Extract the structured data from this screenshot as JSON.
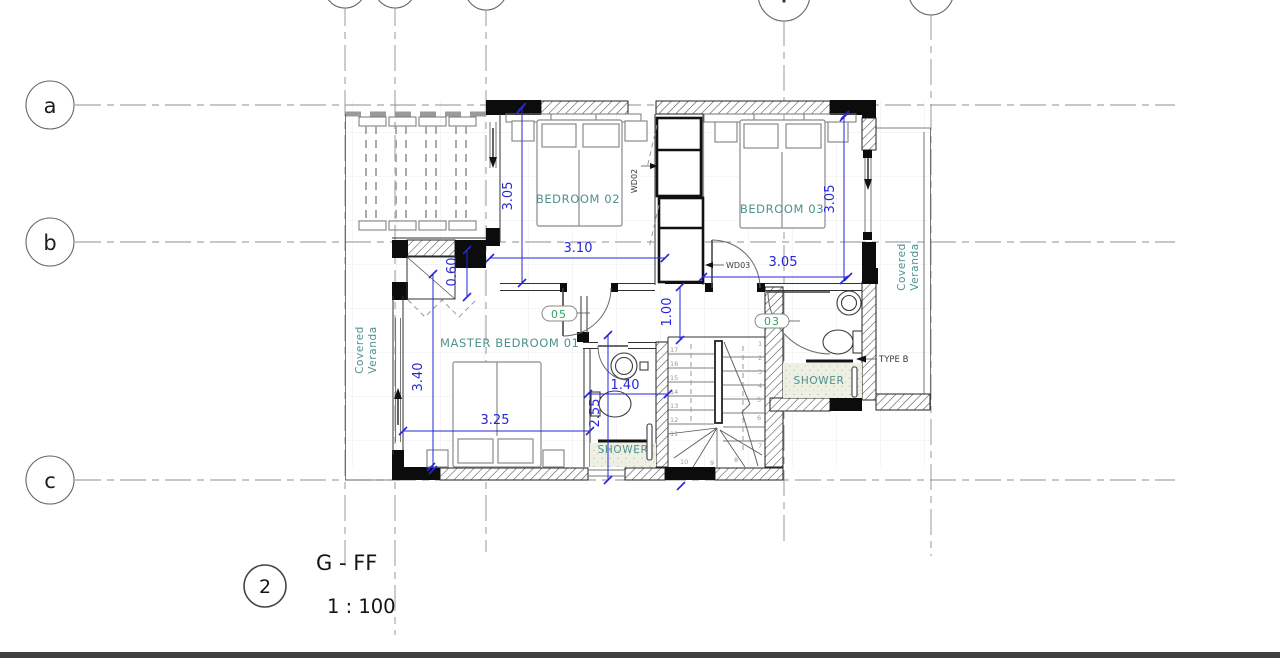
{
  "title_block": {
    "view_number": "2",
    "view_name": "G - FF",
    "view_scale": "1 : 100"
  },
  "grid": {
    "rows": [
      "a",
      "b",
      "c"
    ]
  },
  "rooms": {
    "bedroom02": "BEDROOM 02",
    "bedroom03": "BEDROOM 03",
    "master": "MASTER BEDROOM  01",
    "shower_ensuite": "SHOWER",
    "shower_right": "SHOWER",
    "veranda_left_line1": "Covered",
    "veranda_left_line2": "Veranda",
    "veranda_right_line1": "Covered",
    "veranda_right_line2": "Veranda"
  },
  "dims": {
    "b2_height": "3.05",
    "b2_width": "3.10",
    "b3_width": "3.05",
    "b3_height": "3.05",
    "closet_depth": "0.60",
    "hall_width": "1.00",
    "master_height": "3.40",
    "master_width": "3.25",
    "ensuite_width": "1.40",
    "ensuite_depth": "2.55"
  },
  "tags": {
    "wd02": "WD02",
    "wd03": "WD03",
    "door_master": "05",
    "door_bed3": "03",
    "type_b": "TYPE B"
  },
  "stair": {
    "left": [
      "17",
      "16",
      "15",
      "14",
      "13",
      "12",
      "11"
    ],
    "winder": [
      "10",
      "9",
      "8"
    ],
    "right": [
      "1",
      "2",
      "3",
      "4",
      "5",
      "6",
      "7"
    ]
  },
  "colors": {
    "dimension_blue": "#2626d8",
    "room_label_teal": "#4e918e",
    "tag_green": "#2fa25f",
    "wall_black": "#0c0c0c"
  }
}
